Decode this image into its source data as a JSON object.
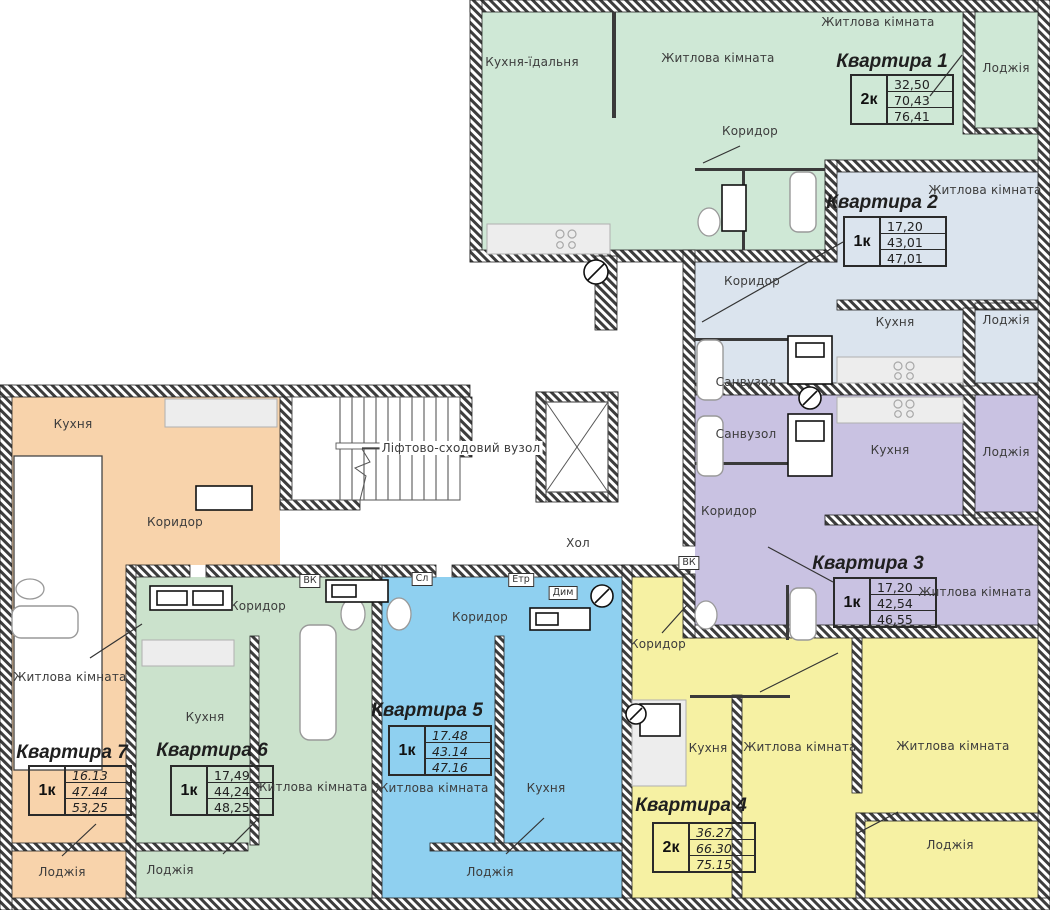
{
  "plan": {
    "stair_label": "Ліфтово-сходовий вузол",
    "hall_label": "Хол",
    "shafts": {
      "vk_a": "ВК",
      "sl": "Сл",
      "etr": "Етр",
      "dym": "Дим",
      "vk_b": "ВК"
    }
  },
  "colors": {
    "apt1": "#cfe8d6",
    "apt2": "#dbe4ee",
    "apt3": "#c9c2e2",
    "apt4": "#f6f1a3",
    "apt5": "#8fd0f0",
    "apt6": "#cbe2cc",
    "apt7": "#f8d3ab",
    "wall": "#3d3d3d"
  },
  "apartments": {
    "apt1": {
      "title": "Квартира 1",
      "type": "2к",
      "area_living": "32,50",
      "area_apt": "70,43",
      "area_total": "76,41",
      "rooms": {
        "kitchen_dining": "Кухня-їдальня",
        "living1": "Житлова кімната",
        "living2": "Житлова кімната",
        "corridor": "Коридор",
        "loggia": "Лоджія"
      }
    },
    "apt2": {
      "title": "Квартира 2",
      "type": "1к",
      "area_living": "17,20",
      "area_apt": "43,01",
      "area_total": "47,01",
      "rooms": {
        "living": "Житлова кімната",
        "kitchen": "Кухня",
        "corridor": "Коридор",
        "bathroom": "Санвузол",
        "loggia": "Лоджія"
      }
    },
    "apt3": {
      "title": "Квартира 3",
      "type": "1к",
      "area_living": "17,20",
      "area_apt": "42,54",
      "area_total": "46,55",
      "rooms": {
        "living": "Житлова кімната",
        "kitchen": "Кухня",
        "corridor": "Коридор",
        "bathroom": "Санвузол",
        "loggia": "Лоджія"
      }
    },
    "apt4": {
      "title": "Квартира 4",
      "type": "2к",
      "area_living": "36.27",
      "area_apt": "66.30",
      "area_total": "75.15",
      "rooms": {
        "kitchen": "Кухня",
        "living1": "Житлова кімната",
        "living2": "Житлова кімната",
        "corridor": "Коридор",
        "loggia": "Лоджія"
      }
    },
    "apt5": {
      "title": "Квартира 5",
      "type": "1к",
      "area_living": "17.48",
      "area_apt": "43.14",
      "area_total": "47.16",
      "rooms": {
        "living": "Житлова кімната",
        "kitchen": "Кухня",
        "corridor": "Коридор",
        "loggia": "Лоджія"
      }
    },
    "apt6": {
      "title": "Квартира 6",
      "type": "1к",
      "area_living": "17,49",
      "area_apt": "44,24",
      "area_total": "48,25",
      "rooms": {
        "living": "Житлова кімната",
        "kitchen": "Кухня",
        "corridor": "Коридор",
        "loggia": "Лоджія"
      }
    },
    "apt7": {
      "title": "Квартира 7",
      "type": "1к",
      "area_living": "16.13",
      "area_apt": "47.44",
      "area_total": "53,25",
      "rooms": {
        "kitchen": "Кухня",
        "living": "Житлова кімната",
        "corridor": "Коридор",
        "loggia": "Лоджія"
      }
    }
  }
}
